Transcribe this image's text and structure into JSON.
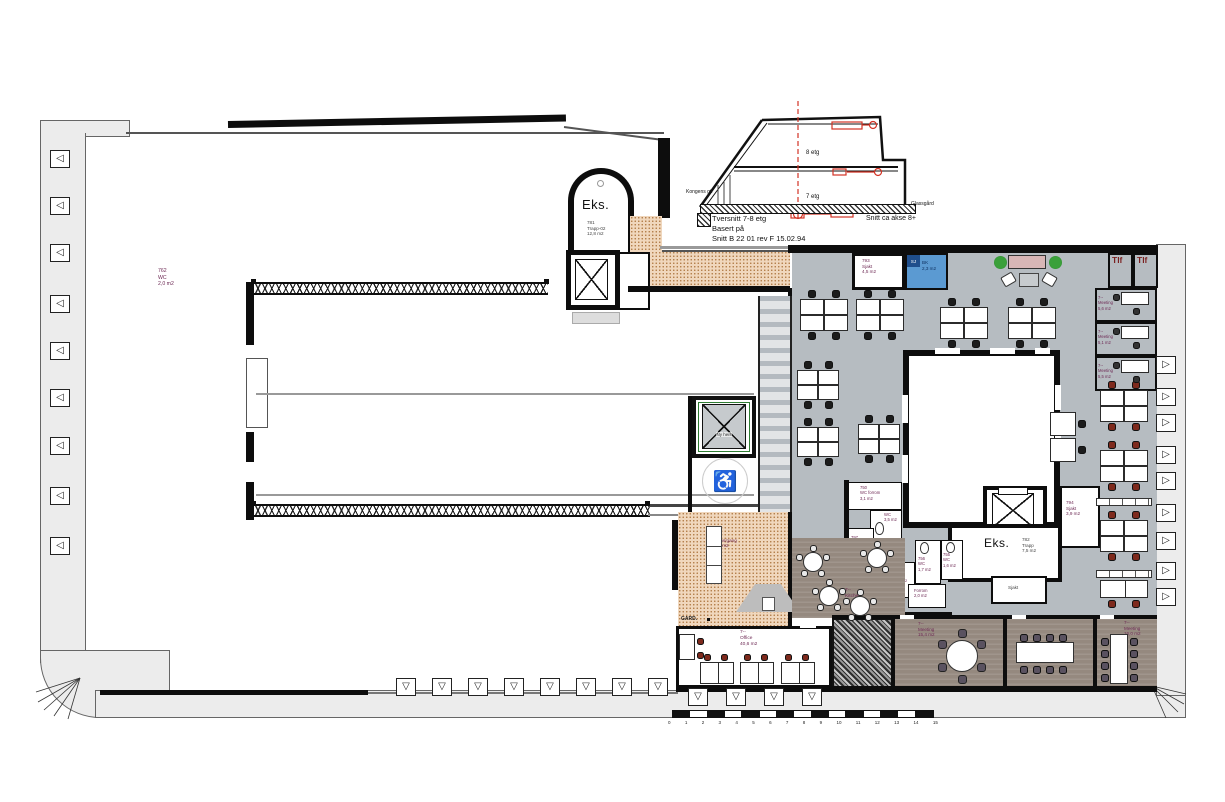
{
  "section": {
    "floor8": "8 etg",
    "floor7": "7 etg",
    "left_street": "Kongens gt.",
    "right_label": "Glassgård",
    "caption1": "Tversnitt 7-8 etg",
    "caption2": "Basert på",
    "caption3": "Snitt B 22 01 rev F 15.02.94",
    "axis_note": "Snitt ca akse 8+"
  },
  "rooms": {
    "wc762": {
      "number": "762",
      "name": "WC",
      "area": "2,0 m2"
    },
    "trapp781": {
      "existing": "Eks.",
      "number": "781",
      "name": "Trapp-02",
      "area": "12,8 m2"
    },
    "sjakt793": {
      "number": "793",
      "name": "Sjakt",
      "area": "4,5 m2"
    },
    "bk": {
      "tag": "SJ",
      "name": "BK",
      "area": "2,3 m2"
    },
    "tlf_left": "Tlf",
    "tlf_right": "Tlf",
    "meeting_a": {
      "number": "7--",
      "name": "Meeting",
      "area": "5,6 m2"
    },
    "meeting_b": {
      "number": "7--",
      "name": "Meeting",
      "area": "5,1 m2"
    },
    "meeting_c": {
      "number": "7--",
      "name": "Meeting",
      "area": "5,5 m2"
    },
    "wc_forrom750": {
      "number": "750",
      "name": "WC forrom",
      "area": "3,1 m2"
    },
    "wc_35": {
      "name": "WC",
      "area": "3,5 m2"
    },
    "sjakt797": {
      "number": "797",
      "name": "Sjakt",
      "area": "2,9 m2"
    },
    "sjakt796": {
      "number": "796",
      "name": "Sjakt",
      "area": "0,9 m2"
    },
    "wc756": {
      "number": "756",
      "name": "WC",
      "area": "1,7 m2"
    },
    "wc755": {
      "number": "755",
      "name": "WC",
      "area": "1,6 m2"
    },
    "forrom": {
      "name": "Forrom",
      "area": "2,0 m2"
    },
    "sjakt794": {
      "number": "794",
      "name": "Sjakt",
      "area": "3,9 m2"
    },
    "trapp782": {
      "existing": "Eks.",
      "number": "782",
      "name": "Trapp",
      "area": "7,5 m2"
    },
    "sjakt_under": {
      "name": "Sjakt"
    },
    "repos783": {
      "number": "783",
      "name": "Repos/gang",
      "area": "30,4 m2"
    },
    "garderobe": "GARD.",
    "office": {
      "number": "7--",
      "name": "Office",
      "area": "40,6 m2"
    },
    "kitchen": {
      "number": "7--",
      "name": "Kitchen",
      "area": "33,6 m2"
    },
    "meeting154": {
      "number": "7--",
      "name": "Meeting",
      "area": "15,4 m2"
    },
    "meeting239": {
      "number": "7--",
      "name": "Meeting",
      "area": "23,9 m2"
    },
    "meeting160": {
      "number": "7--",
      "name": "Meeting",
      "area": "16,0 m2"
    },
    "ny_heis": "Ny heis"
  },
  "scale_bar": {
    "ticks": [
      "0",
      "1",
      "2",
      "3",
      "4",
      "5",
      "6",
      "7",
      "8",
      "9",
      "10",
      "11",
      "12",
      "13",
      "14",
      "15"
    ]
  },
  "colors": {
    "office_floor": "#b6bcc1",
    "meeting_floor": "#95897f",
    "corridor_stipple": "#f0d7bd",
    "bk_blue": "#5b9ad2",
    "chair_black": "#1c1c1c",
    "chair_maroon": "#7e2a1d",
    "chair_plum": "#5a5260",
    "accent_red": "#d23325",
    "label_plum": "#6e2a55"
  }
}
